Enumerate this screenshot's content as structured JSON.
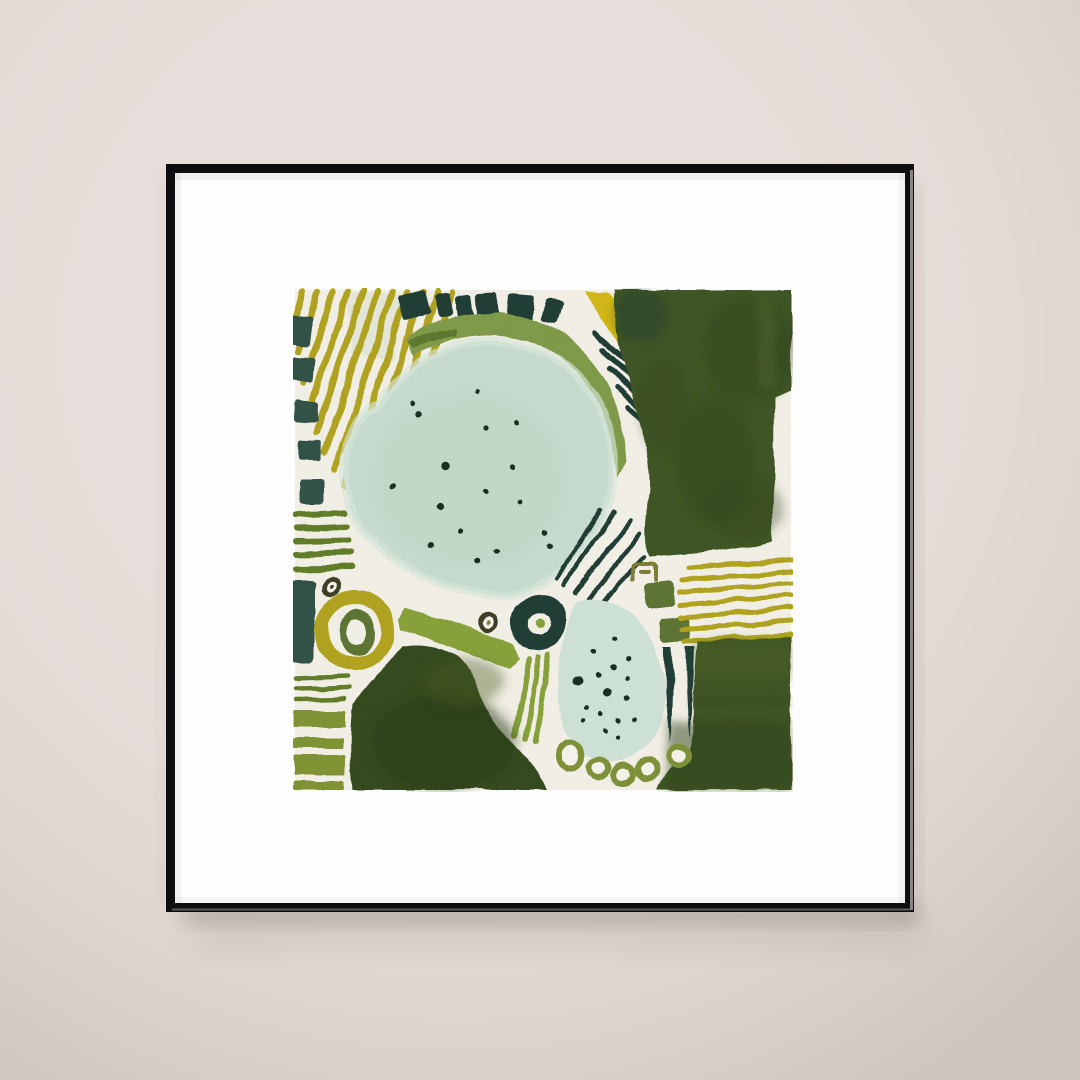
{
  "scene": {
    "description": "Photograph of a framed abstract watercolor art print hanging on a plain warm-beige wall",
    "wall_color": "#e7dfdb",
    "frame_color": "#0e0e10",
    "frame_highlight": "#efe9e5",
    "mat_color": "#fdfdfd",
    "shadow_color": "#6b5c55"
  },
  "artwork": {
    "medium": "abstract watercolor print, green palette",
    "palette": {
      "paper": "#f4f1e8",
      "mint": "#c7ddd0",
      "mint_light": "#cfe3d8",
      "mint_rim": "#d9e8dc",
      "dot": "#182a1f",
      "olive_yellow": "#b1a31c",
      "yellow": "#d4b812",
      "olive_mid": "#7d9a46",
      "olive_band": "#86a139",
      "olive_stripe": "#5e7c27",
      "olive_block": "#7e9331",
      "olive_dark": "#5c7330",
      "donut_olive": "#7d9134",
      "teal": "#1e3a33",
      "teal_soft": "#2e4f45",
      "forest": "#3c5321",
      "forest_dark": "#2f451c",
      "forest_deep": "#31471b",
      "khaki": "#7b7b33",
      "moss_dark": "#3a3c22"
    },
    "elements": [
      "fan of 11 diagonal olive-yellow stripes, top left",
      "arc of 6 dark teal dashes along the top",
      "column of 5 dark teal blocks, left edge",
      "olive-green arc sweeping over the large oval",
      "bright yellow bent band with 5 dark dashes, top right",
      "dark forest-green field, upper right",
      "large mint-green oval speckled with 17 ink dots",
      "5 horizontal olive stripes, mid left",
      "small ringed dot above olive ring",
      "dark teal block, lower left",
      "olive-yellow ring with dark core, lower left",
      "7 horizontal olive bars, bottom left",
      "thick olive diagonal band plus 3 short diagonal strokes",
      "fan of 5 dark teal rays, center",
      "small khaki open-square doodle",
      "two dark olive tilted squares",
      "chunky dark teal ring (eye) with olive center dot",
      "small ringed dot with olive center, center",
      "7 horizontal olive-yellow stripes, right",
      "mint-green teardrop speckled with 16 ink dots",
      "five olive ring beads along the bottom",
      "two tapered dark teal vertical strokes",
      "large dark green blob, bottom left",
      "dark green field, bottom right"
    ]
  }
}
